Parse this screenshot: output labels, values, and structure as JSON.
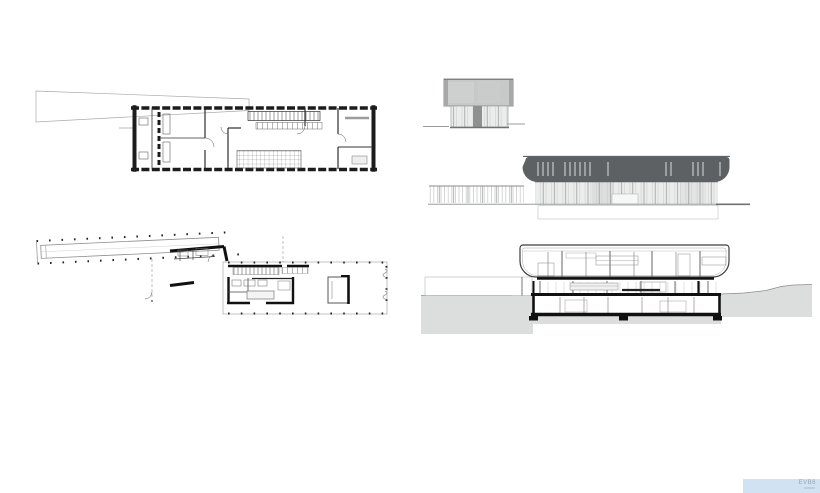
{
  "watermark": {
    "text": "EVB6"
  },
  "colors": {
    "paper": "#ffffff",
    "line_dark": "#1c1c1c",
    "line_mid": "#6f7271",
    "line_light": "#b9bbba",
    "roof_band": "#5d6164",
    "panel_grey": "#c7c9c8",
    "glazing_grey": "#ebedec",
    "ground_grey": "#dcdedd",
    "watermark_band": "#cfe3f2",
    "watermark_text": "#90a9be"
  }
}
